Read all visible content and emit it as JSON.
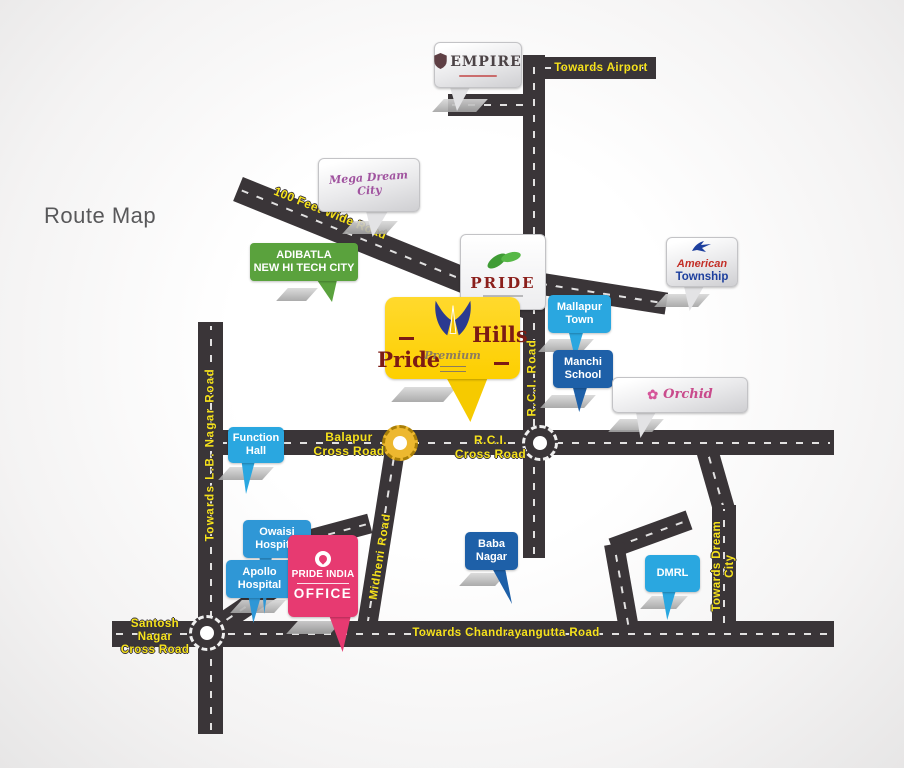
{
  "title": "Route Map",
  "colors": {
    "road": "#3a3538",
    "road_label_yellow": "#f6e21b",
    "callout_light_blue": "#2aa7e0",
    "callout_medium_blue": "#2f97d6",
    "callout_dark_blue": "#1e60a8",
    "callout_green": "#5aa23d",
    "callout_pink": "#e73a71",
    "callout_yellow": "#fdcf00",
    "logo_maroon": "#7c1b14",
    "logo_navy": "#2b3a90"
  },
  "road_labels": {
    "towards_airport": "Towards Airport",
    "feet_wide_road": "100 Feet Wide Road",
    "rci_road": "R.C.I. Road",
    "towards_lb_nagar": "Towards L.B. Nagar Road",
    "midheni_road": "Midheni Road",
    "towards_dream_city": "Towards Dream City",
    "towards_chandrayangutta": "Towards Chandrayangutta Road"
  },
  "junctions": {
    "balapur": "Balapur\nCross Road",
    "rci": "R.C.I.\nCross Road",
    "santosh": "Santosh Nagar\nCross Road"
  },
  "callouts": {
    "empire": {
      "name": "EMPIRE"
    },
    "mega_dream_city": {
      "name": "Mega Dream City"
    },
    "pride": {
      "name": "PRIDE"
    },
    "adibatla": {
      "label": "ADIBATLA\nNEW HI TECH CITY"
    },
    "pride_hills": {
      "word1": "Pride",
      "word2": "Hills",
      "tagline": "Premium"
    },
    "mallapur_town": {
      "label": "Mallapur\nTown"
    },
    "manchi_school": {
      "label": "Manchi\nSchool"
    },
    "american_township": {
      "word1": "American",
      "word2": "Township"
    },
    "orchid": {
      "name": "Orchid"
    },
    "function_hall": {
      "label": "Function\nHall"
    },
    "owaisi_hospital": {
      "label": "Owaisi\nHospital"
    },
    "apollo_hospital": {
      "label": "Apollo\nHospital"
    },
    "pride_india_office": {
      "line1": "PRIDE INDIA",
      "line2": "OFFICE"
    },
    "baba_nagar": {
      "label": "Baba\nNagar"
    },
    "dmrl": {
      "label": "DMRL"
    }
  }
}
